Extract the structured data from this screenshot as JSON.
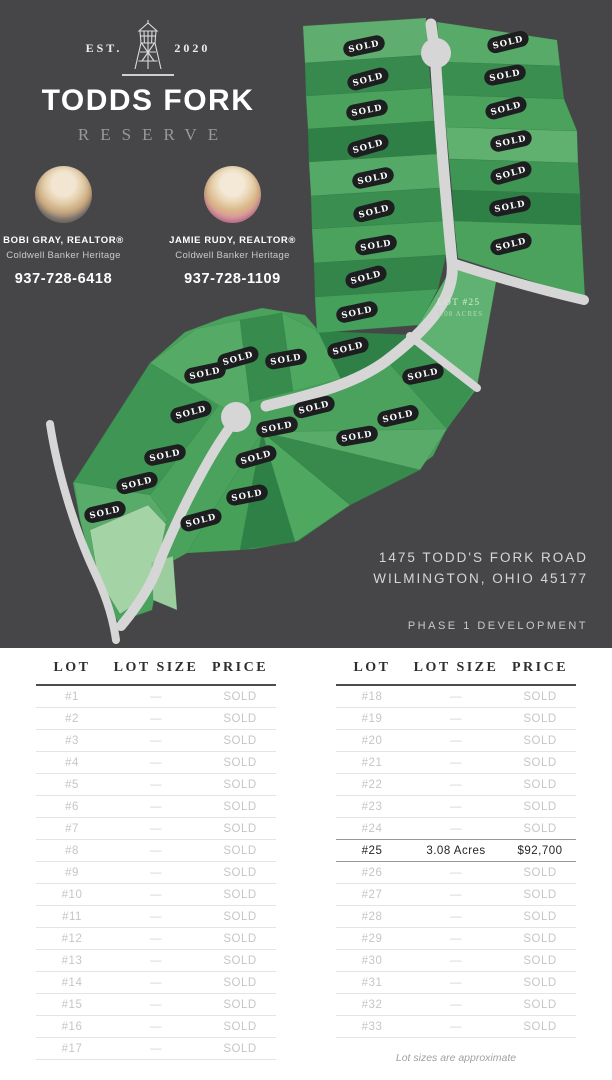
{
  "brand": {
    "est_left": "EST.",
    "est_right": "2020",
    "title": "TODDS FORK",
    "subtitle": "RESERVE"
  },
  "agents": [
    {
      "name": "BOBI GRAY, REALTOR®",
      "company": "Coldwell Banker Heritage",
      "phone": "937-728-6418"
    },
    {
      "name": "JAMIE RUDY, REALTOR®",
      "company": "Coldwell Banker Heritage",
      "phone": "937-728-1109"
    }
  ],
  "address": {
    "line1": "1475 TODD'S FORK ROAD",
    "line2": "WILMINGTON, OHIO 45177",
    "phase": "PHASE 1 DEVELOPMENT"
  },
  "map": {
    "sold_label": "SOLD",
    "available_lot": {
      "name": "LOT #25",
      "size": "3.08 ACRES"
    },
    "badge_color": "#1c1e20",
    "colors": {
      "background": "#464649",
      "road": "#d6d6d7",
      "green_medium": "#4aa25d",
      "green_dark": "#37894c",
      "green_darker": "#2f8046",
      "green_light": "#58ab69",
      "green_pale": "#a4d3a6"
    },
    "sold_badges": [
      {
        "x": 364,
        "y": 46,
        "rot": -12
      },
      {
        "x": 368,
        "y": 79,
        "rot": -15
      },
      {
        "x": 367,
        "y": 110,
        "rot": -11
      },
      {
        "x": 368,
        "y": 146,
        "rot": -16
      },
      {
        "x": 373,
        "y": 178,
        "rot": -12
      },
      {
        "x": 374,
        "y": 211,
        "rot": -14
      },
      {
        "x": 376,
        "y": 245,
        "rot": -10
      },
      {
        "x": 366,
        "y": 277,
        "rot": -15
      },
      {
        "x": 357,
        "y": 312,
        "rot": -12
      },
      {
        "x": 508,
        "y": 42,
        "rot": -14
      },
      {
        "x": 505,
        "y": 75,
        "rot": -11
      },
      {
        "x": 506,
        "y": 108,
        "rot": -15
      },
      {
        "x": 511,
        "y": 141,
        "rot": -12
      },
      {
        "x": 511,
        "y": 173,
        "rot": -16
      },
      {
        "x": 510,
        "y": 206,
        "rot": -11
      },
      {
        "x": 511,
        "y": 244,
        "rot": -14
      },
      {
        "x": 205,
        "y": 373,
        "rot": -12
      },
      {
        "x": 238,
        "y": 358,
        "rot": -16
      },
      {
        "x": 286,
        "y": 359,
        "rot": -10
      },
      {
        "x": 348,
        "y": 348,
        "rot": -14
      },
      {
        "x": 423,
        "y": 374,
        "rot": -12
      },
      {
        "x": 191,
        "y": 412,
        "rot": -15
      },
      {
        "x": 277,
        "y": 427,
        "rot": -11
      },
      {
        "x": 314,
        "y": 407,
        "rot": -14
      },
      {
        "x": 165,
        "y": 455,
        "rot": -12
      },
      {
        "x": 256,
        "y": 457,
        "rot": -16
      },
      {
        "x": 357,
        "y": 436,
        "rot": -10
      },
      {
        "x": 398,
        "y": 416,
        "rot": -13
      },
      {
        "x": 137,
        "y": 483,
        "rot": -14
      },
      {
        "x": 247,
        "y": 495,
        "rot": -11
      },
      {
        "x": 105,
        "y": 512,
        "rot": -13
      },
      {
        "x": 201,
        "y": 520,
        "rot": -15
      }
    ]
  },
  "tables": {
    "headers": [
      "LOT",
      "LOT SIZE",
      "PRICE"
    ],
    "left_rows": [
      {
        "lot": "#1",
        "size": "—",
        "price": "SOLD"
      },
      {
        "lot": "#2",
        "size": "—",
        "price": "SOLD"
      },
      {
        "lot": "#3",
        "size": "—",
        "price": "SOLD"
      },
      {
        "lot": "#4",
        "size": "—",
        "price": "SOLD"
      },
      {
        "lot": "#5",
        "size": "—",
        "price": "SOLD"
      },
      {
        "lot": "#6",
        "size": "—",
        "price": "SOLD"
      },
      {
        "lot": "#7",
        "size": "—",
        "price": "SOLD"
      },
      {
        "lot": "#8",
        "size": "—",
        "price": "SOLD"
      },
      {
        "lot": "#9",
        "size": "—",
        "price": "SOLD"
      },
      {
        "lot": "#10",
        "size": "—",
        "price": "SOLD"
      },
      {
        "lot": "#11",
        "size": "—",
        "price": "SOLD"
      },
      {
        "lot": "#12",
        "size": "—",
        "price": "SOLD"
      },
      {
        "lot": "#13",
        "size": "—",
        "price": "SOLD"
      },
      {
        "lot": "#14",
        "size": "—",
        "price": "SOLD"
      },
      {
        "lot": "#15",
        "size": "—",
        "price": "SOLD"
      },
      {
        "lot": "#16",
        "size": "—",
        "price": "SOLD"
      },
      {
        "lot": "#17",
        "size": "—",
        "price": "SOLD"
      }
    ],
    "right_rows": [
      {
        "lot": "#18",
        "size": "—",
        "price": "SOLD"
      },
      {
        "lot": "#19",
        "size": "—",
        "price": "SOLD"
      },
      {
        "lot": "#20",
        "size": "—",
        "price": "SOLD"
      },
      {
        "lot": "#21",
        "size": "—",
        "price": "SOLD"
      },
      {
        "lot": "#22",
        "size": "—",
        "price": "SOLD"
      },
      {
        "lot": "#23",
        "size": "—",
        "price": "SOLD"
      },
      {
        "lot": "#24",
        "size": "—",
        "price": "SOLD"
      },
      {
        "lot": "#25",
        "size": "3.08 Acres",
        "price": "$92,700",
        "highlight": true
      },
      {
        "lot": "#26",
        "size": "—",
        "price": "SOLD"
      },
      {
        "lot": "#27",
        "size": "—",
        "price": "SOLD"
      },
      {
        "lot": "#28",
        "size": "—",
        "price": "SOLD"
      },
      {
        "lot": "#29",
        "size": "—",
        "price": "SOLD"
      },
      {
        "lot": "#30",
        "size": "—",
        "price": "SOLD"
      },
      {
        "lot": "#31",
        "size": "—",
        "price": "SOLD"
      },
      {
        "lot": "#32",
        "size": "—",
        "price": "SOLD"
      },
      {
        "lot": "#33",
        "size": "—",
        "price": "SOLD"
      }
    ],
    "note": "Lot sizes are approximate"
  }
}
